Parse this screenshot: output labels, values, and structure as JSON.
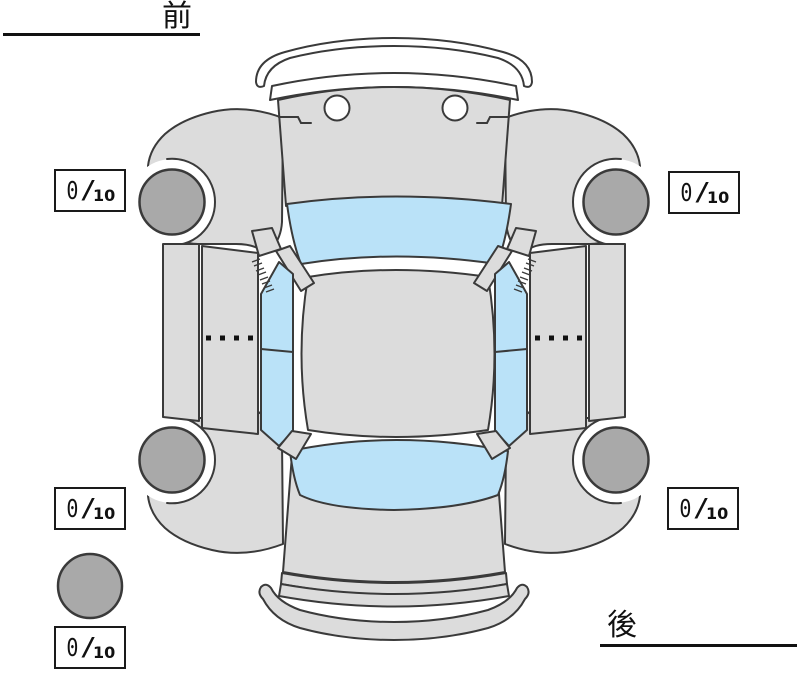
{
  "orientation": {
    "front": "前",
    "rear": "後"
  },
  "ratings": {
    "front_left": {
      "value": "0",
      "slash": "/",
      "max": "10"
    },
    "front_right": {
      "value": "0",
      "slash": "/",
      "max": "10"
    },
    "rear_left": {
      "value": "0",
      "slash": "/",
      "max": "10"
    },
    "rear_right": {
      "value": "0",
      "slash": "/",
      "max": "10"
    },
    "spare": {
      "value": "0",
      "slash": "/",
      "max": "10"
    }
  },
  "colors": {
    "bg": "#ffffff",
    "body": "#dcdcdc",
    "glass": "#bae2f8",
    "wheel": "#a9a9a9",
    "outline": "#3a3a3a",
    "ink": "#111111",
    "box-border": "#1a1a1a"
  }
}
